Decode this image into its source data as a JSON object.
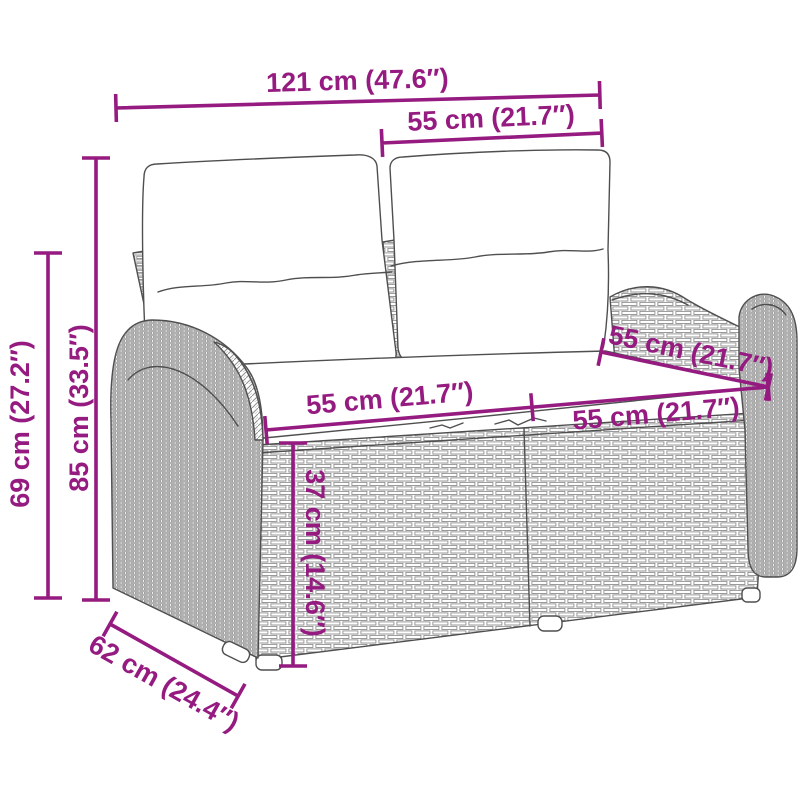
{
  "colors": {
    "accent": "#951b81",
    "sketch": "#4f4f4f",
    "weave": "#8f8f8f",
    "background": "#ffffff"
  },
  "diagram": {
    "dimensions": {
      "total_width": "121 cm (47.6″)",
      "backrest_cushion_width": "55 cm (21.7″)",
      "total_height": "85 cm (33.5″)",
      "armrest_height": "69 cm (27.2″)",
      "seat_width_left": "55 cm (21.7″)",
      "seat_width_right": "55 cm (21.7″)",
      "seat_depth": "55 cm (21.7″)",
      "seat_height": "37 cm (14.6″)",
      "base_depth": "62 cm (24.4″)"
    }
  }
}
